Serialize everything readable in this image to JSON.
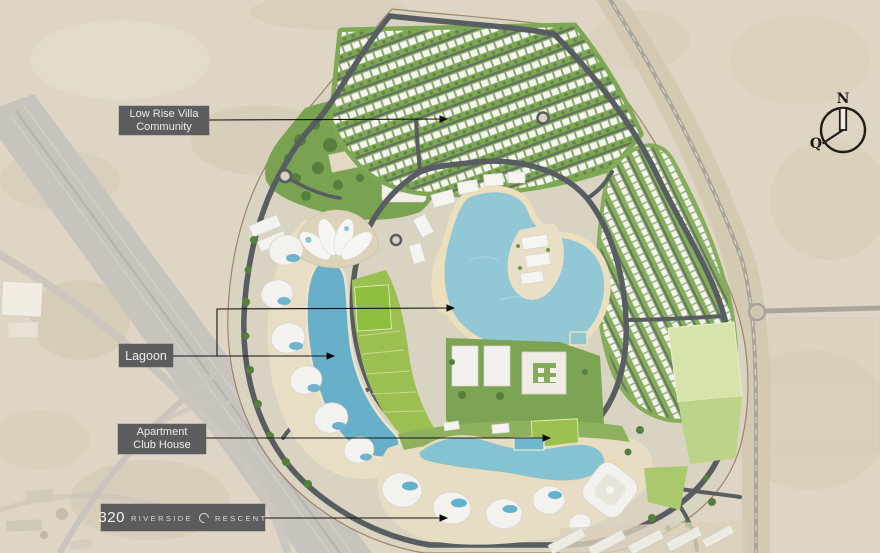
{
  "labels": {
    "villa_community": {
      "line1": "Low Rise Villa",
      "line2": "Community"
    },
    "lagoon": {
      "text": "Lagoon"
    },
    "apartment_club_house": {
      "line1": "Apartment",
      "line2": "Club House"
    },
    "brand": {
      "number": "320",
      "word1": "RIVERSIDE",
      "word2": "RESCENT"
    }
  },
  "compass": {
    "north": "N",
    "qibla": "Q"
  },
  "icons": {
    "crescent_icon": "open-ring crescent replacing letter C of CRESCENT",
    "compass_icon": "circle compass with north needle and qibla pointer"
  },
  "colors": {
    "sand": "#ded5c4",
    "site_sand": "#d9d3c1",
    "lagoon_main": "#92c8d5",
    "lagoon_crescent": "#68b0c9",
    "beach": "#ecdfbd",
    "green_main": "#7fa855",
    "green_bright": "#8fbf3f",
    "green_pale_field": "#d6e3aa",
    "road_dark": "#575d61",
    "road_desert": "#cbc7bf",
    "label_bg": "#545557",
    "label_text": "#ececec",
    "boundary": "#8a6b4e",
    "leader_line": "#141414"
  }
}
